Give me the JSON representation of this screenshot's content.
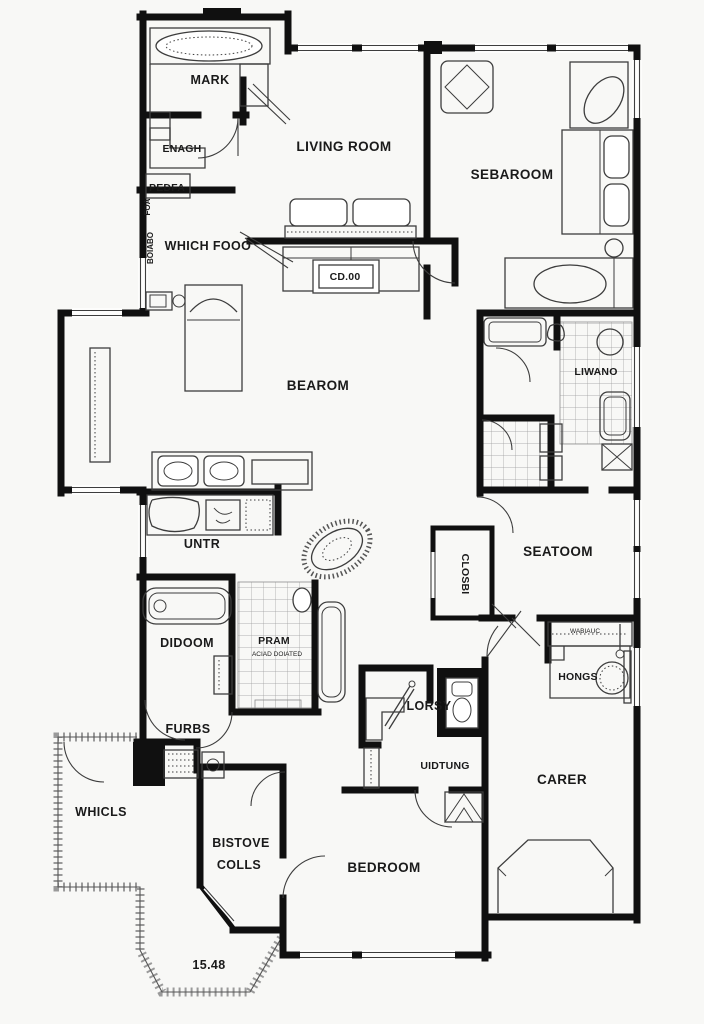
{
  "document": {
    "kind": "architectural floor plan"
  },
  "colors": {
    "background": "#f8f8f6",
    "wall": "#101010",
    "furniture_line": "#3d3d3d",
    "tile_line": "#8c8c8c",
    "label_text": "#1a1a1a",
    "deck_line": "#555555"
  },
  "labels": {
    "mark": "MARK",
    "enagh": "ENAGH",
    "pedfa": "PEDFA",
    "foa": "FOA",
    "bonbo": "BOIABO",
    "living_room": "LIVING ROOM",
    "sebaroom": "SEBAROOM",
    "which_fooo": "WHICH FOOO",
    "bearom": "BEAROM",
    "liwano": "LIWANO",
    "untr": "UNTR",
    "seatoom": "SEATOOM",
    "closbi": "CLOSBI",
    "didoom": "DIDOOM",
    "pram": "PRAM",
    "pram_sub": "ACIAD DOIATED",
    "furbs": "FURBS",
    "lorsy": "LORSY",
    "uidtung": "UIDTUNG",
    "wabiauc": "WABIAUC",
    "hongs": "HONGS",
    "whicls": "WHICLS",
    "bistove_line1": "BISTOVE",
    "bistove_line2": "COLLS",
    "carer": "CARER",
    "bedroom": "BEDROOM",
    "cd_table": "CD.00",
    "dimension": "15.48"
  }
}
